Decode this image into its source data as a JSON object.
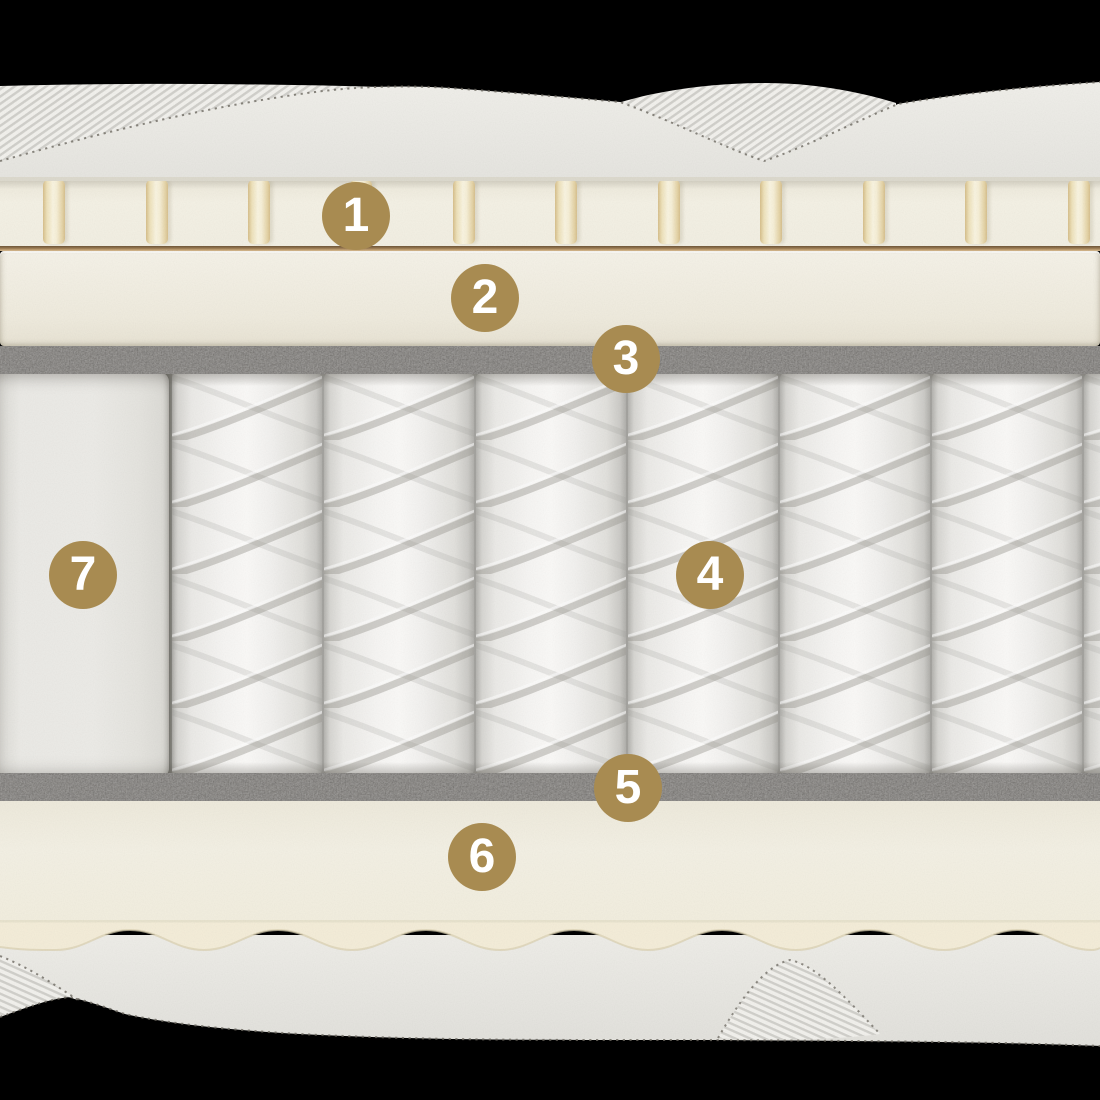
{
  "diagram": {
    "badges": [
      {
        "label": "1"
      },
      {
        "label": "2"
      },
      {
        "label": "3"
      },
      {
        "label": "4"
      },
      {
        "label": "5"
      },
      {
        "label": "6"
      },
      {
        "label": "7"
      }
    ],
    "colors": {
      "badge_gold": "#A88B51",
      "foam_cream": "#F3F0E4",
      "slat_cream": "#F8F2DC",
      "glue_brown": "#9A7A52",
      "felt_gray": "#4A4641",
      "fabric_white": "#EDECE8",
      "spring_fabric": "#F7F6F4",
      "background": "#000000"
    }
  }
}
